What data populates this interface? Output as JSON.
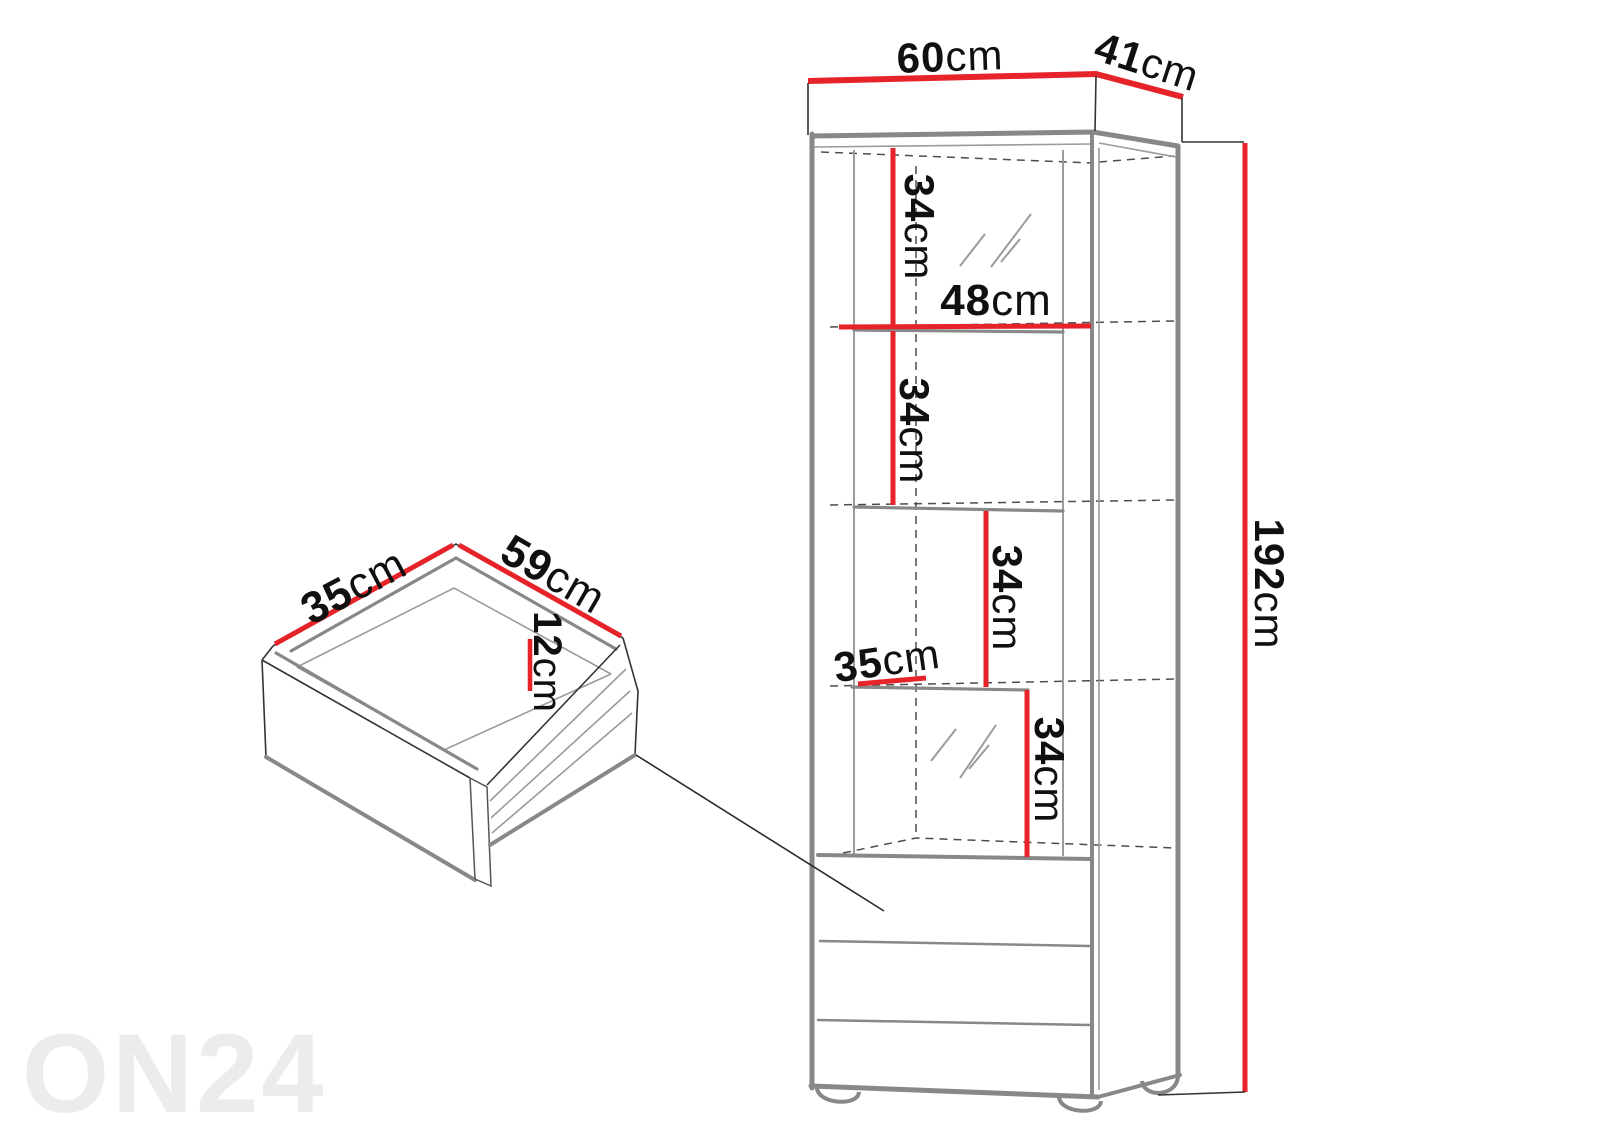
{
  "watermark": "ON24",
  "colors": {
    "dimension_red": "#e52329",
    "outline_gray": "#888888",
    "line_thin": "#9b9b9b",
    "dash_gray": "#4d4d4d",
    "text": "#101010",
    "watermark_gray": "#ececec"
  },
  "cabinet": {
    "top_width": {
      "value": "60",
      "unit": "cm"
    },
    "top_depth": {
      "value": "41",
      "unit": "cm"
    },
    "height": {
      "value": "192",
      "unit": "cm"
    },
    "shelf_width": {
      "value": "48",
      "unit": "cm"
    },
    "shelf_depth": {
      "value": "35",
      "unit": "cm"
    },
    "compartment_heights": [
      {
        "value": "34",
        "unit": "cm"
      },
      {
        "value": "34",
        "unit": "cm"
      },
      {
        "value": "34",
        "unit": "cm"
      },
      {
        "value": "34",
        "unit": "cm"
      }
    ]
  },
  "drawer": {
    "depth": {
      "value": "35",
      "unit": "cm"
    },
    "width": {
      "value": "59",
      "unit": "cm"
    },
    "height": {
      "value": "12",
      "unit": "cm"
    }
  }
}
